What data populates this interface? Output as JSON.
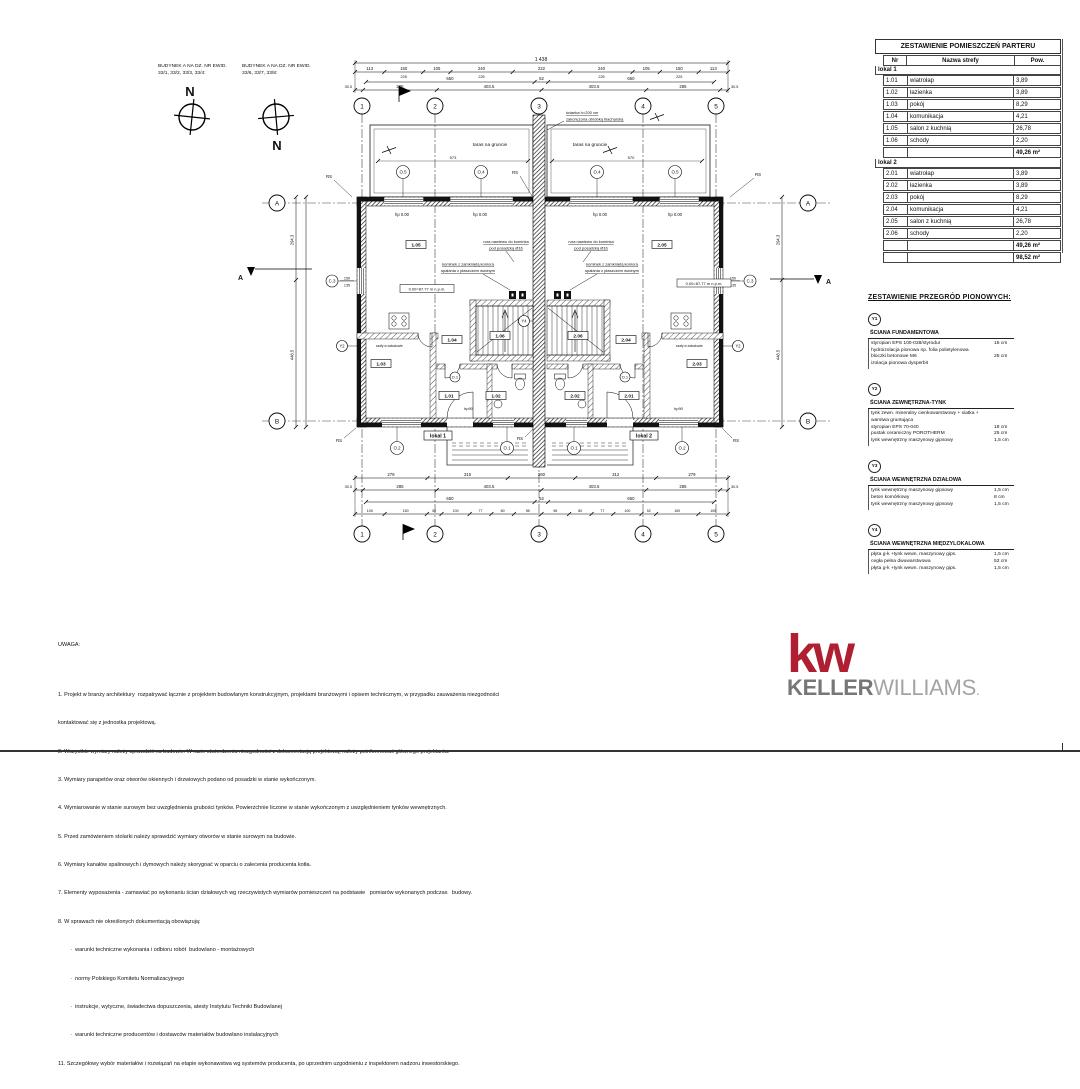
{
  "header_left": {
    "building1_line1": "BUDYNEK A NA DZ. NR EWID.",
    "building1_line2": "33/1, 33/2, 33/3, 33/4:",
    "building2_line1": "BUDYNEK A NA DZ. NR EWID.",
    "building2_line2": "33/6, 33/7, 33/8:",
    "north": "N"
  },
  "room_table": {
    "title": "ZESTAWIENIE POMIESZCZEŃ PARTERU",
    "columns": {
      "nr": "Nr",
      "name": "Nazwa strefy",
      "area": "Pow."
    },
    "lokal1": {
      "label": "lokal 1",
      "rows": [
        {
          "nr": "1.01",
          "name": "wiatrołap",
          "area": "3,89"
        },
        {
          "nr": "1.02",
          "name": "łazienka",
          "area": "3,89"
        },
        {
          "nr": "1.03",
          "name": "pokój",
          "area": "8,29"
        },
        {
          "nr": "1.04",
          "name": "komunikacja",
          "area": "4,21"
        },
        {
          "nr": "1.05",
          "name": "salon z kuchnią",
          "area": "26,78"
        },
        {
          "nr": "1.06",
          "name": "schody",
          "area": "2,20"
        }
      ],
      "sum": "49,26 m²"
    },
    "lokal2": {
      "label": "lokal 2",
      "rows": [
        {
          "nr": "2.01",
          "name": "wiatrołap",
          "area": "3,89"
        },
        {
          "nr": "2.02",
          "name": "łazienka",
          "area": "3,89"
        },
        {
          "nr": "2.03",
          "name": "pokój",
          "area": "8,29"
        },
        {
          "nr": "2.04",
          "name": "komunikacja",
          "area": "4,21"
        },
        {
          "nr": "2.05",
          "name": "salon z kuchnią",
          "area": "26,78"
        },
        {
          "nr": "2.06",
          "name": "schody",
          "area": "2,20"
        }
      ],
      "sum": "49,26 m²"
    },
    "total": "98,52 m²"
  },
  "partitions": {
    "title": "ZESTAWIENIE PRZEGRÓD PIONOWYCH:",
    "items": [
      {
        "mark": "Y1",
        "name": "ŚCIANA FUNDAMENTOWA",
        "layers": [
          {
            "desc": "styropian EPS 100-038/styrodur",
            "thick": "15 cm"
          },
          {
            "desc": "hydroizolacja pionowa np. folia polietylenowa",
            "thick": ""
          },
          {
            "desc": "bloczki betonowe M6",
            "thick": "25 cm"
          },
          {
            "desc": "izolacja pionowa dysperbit",
            "thick": ""
          }
        ]
      },
      {
        "mark": "Y2",
        "name": "ŚCIANA ZEWNĘTRZNA-TYNK",
        "layers": [
          {
            "desc": "tynk zewn. mineralny cienkowarstwowy + siatka + warstwa gruntująca",
            "thick": ""
          },
          {
            "desc": "styropian EPS 70-040",
            "thick": "18 cm"
          },
          {
            "desc": "pustak ceramiczny POROTHERM",
            "thick": "25 cm"
          },
          {
            "desc": "tynk wewnętrzny maszynowy gipsowy",
            "thick": "1,5 cm"
          }
        ]
      },
      {
        "mark": "Y3",
        "name": "ŚCIANA WEWNĘTRZNA DZIAŁOWA",
        "layers": [
          {
            "desc": "tynk wewnętrzny maszynowy gipsowy",
            "thick": "1,5 cm"
          },
          {
            "desc": "beton komórkowy",
            "thick": "8 cm"
          },
          {
            "desc": "tynk wewnętrzny maszynowy gipsowy",
            "thick": "1,5 cm"
          }
        ]
      },
      {
        "mark": "Y4",
        "name": "ŚCIANA WEWNĘTRZNA MIĘDZYLOKALOWA",
        "layers": [
          {
            "desc": "płyta g-k +tynk wewn. maszynowy gips.",
            "thick": "1,5 cm"
          },
          {
            "desc": "cegła pełna dwuwarstwowa",
            "thick": "52 cm"
          },
          {
            "desc": "płyta g-k +tynk wewn. maszynowy gips.",
            "thick": "1,5 cm"
          }
        ]
      }
    ]
  },
  "notes": {
    "title": "UWAGA:",
    "lines": [
      "1. Projekt w branży architektury  rozpatrywać łącznie z projektem budowlanym konstrukcyjnym, projektami branżowymi i opisem technicznym, w przypadku zauważenia niezgodności",
      "kontaktować się z jednostka projektową.",
      "2. Wszystkie wymiary należy sprawdzić na budowie. W razie stwierdzenia niezgodności z dokumentacją projektową, należy poinformować głównego projektanta.",
      "3. Wymiary parapetów oraz otworów okiennych i drzwiowych podano od posadzki w stanie wykończonym.",
      "4. Wymiarowanie w stanie surowym bez uwzględnienia grubości tynków. Powierzchnie liczone w stanie wykończonym z uwzględnieniem tynków wewnętrznych.",
      "5. Przed zamówieniem stolarki należy sprawdzić wymiary otworów w stanie surowym na budowie.",
      "6. Wymiary kanałów spalinowych i dymowych należy skorygoać w oparciu o zalecenia producenta kotła.",
      "7. Elementy wyposażenia - zamawiać po wykonaniu ścian działowych wg rzeczywistych wymiarów pomieszczeń na podstawie   pomiarów wykonanych podczas   budowy.",
      "8. W sprawach nie określonych dokumentacją obowiązują:",
      "        ·  warunki techniczne wykonania i odbioru robót  budowlano - montażowych",
      "        ·  normy Polskiego Komitetu Normalizacyjnego",
      "        ·  instrukcje, wytyczne, świadectwa dopuszczenia, atesty Instytutu Techniki Budowlanej",
      "        ·  warunki techniczne producentów i dostawców materiałów budowlano instalacyjnych",
      "11. Szczegółowy wybór materiałów i rozwiązań na etapie wykonawstwa wg systemów producenta, po uprzednim uzgodnieniu z inspektorem nadzoru inwestorskiego."
    ]
  },
  "logo": {
    "kw": "kw",
    "keller": "KELLER",
    "williams": "WILLIAMS",
    "dot": ".",
    "red": "#b01e32",
    "gray_dark": "#76777a",
    "gray_light": "#a2a4a7"
  },
  "plan": {
    "grid_cols": [
      "1",
      "2",
      "3",
      "4",
      "5"
    ],
    "grid_rows": [
      "A",
      "B"
    ],
    "dims": {
      "total": "1 438",
      "top_windows": [
        "113",
        "150",
        "105",
        "240",
        "222",
        "240",
        "105",
        "150",
        "113"
      ],
      "win_height": "225",
      "inner": [
        "650",
        "52",
        "650"
      ],
      "axes": [
        "30.5",
        "285",
        "403.5",
        "403.5",
        "285",
        "30.5"
      ],
      "bottom_rooms": [
        "279",
        "310",
        "260",
        "312",
        "279"
      ],
      "bottom_small": [
        "105",
        "150",
        "52",
        "100",
        "77",
        "80",
        "98",
        "98",
        "80",
        "77",
        "100",
        "52",
        "150",
        "105"
      ],
      "v_left": [
        "294.3",
        "448.5"
      ],
      "terrace_left": "573",
      "terrace_right": "570",
      "c3_w": "150",
      "c3_h": "135"
    },
    "marks": {
      "o5": "O.5",
      "o4": "O.4",
      "o1": "O.1",
      "o2": "O.2",
      "c3": "C.3",
      "d1": "D.1",
      "y2": "Y2",
      "y4": "Y4",
      "rs": "RS"
    },
    "texts": {
      "taras": "taras na gruncie",
      "hp0": "hp 0.00",
      "hp90": "hp90",
      "lokal1": "lokal 1",
      "lokal2": "lokal 2",
      "bench": "0.00=87.77 m n.p.m.",
      "section": "A",
      "szafy": "szafy w zabudowie",
      "anno_wall1": "ścianka h=200 cm",
      "anno_wall2": "zakończona obróbką blacharską",
      "anno_rura1": "rura nawiewu do kominka",
      "anno_rura2": "pod posadzką Ø16",
      "anno_kominek1": "kominek z zamkniętą komorą",
      "anno_kominek2": "spalania z płaszczem wodnym"
    }
  }
}
